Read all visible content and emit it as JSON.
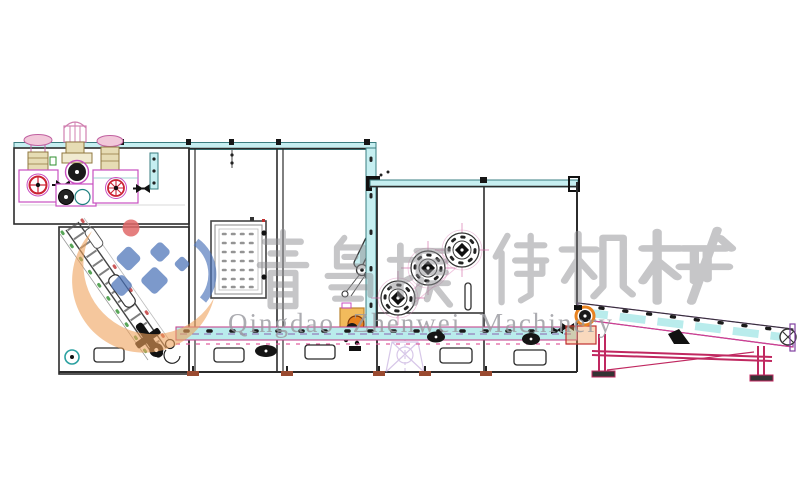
{
  "watermark": {
    "company_cn": "青岛振伟机械",
    "company_cn_chars": [
      "青",
      "岛",
      "振",
      "伟",
      "机",
      "械"
    ],
    "company_en": "Qingdao Zhenwei Machinery",
    "logo_colors": {
      "swoosh": "#efa25c",
      "diamond": "#4a72b8",
      "accent_dot": "#e06868",
      "text_gray": "#9b9ba1"
    }
  },
  "palette": {
    "line_dark": "#2b2b2b",
    "rail_cyan": "#c6eff1",
    "rail_edge": "#3a7d80",
    "machine_magenta": "#c84fc0",
    "motor_red": "#cc2233",
    "belt_cyan": "#b9ecec",
    "belt_magenta": "#c7498f",
    "belt_purple": "#8040a0",
    "frame_crimson": "#c02860",
    "drive_orange": "#e8821e",
    "shaft_khaki": "#e6dcb4",
    "ghost_purple": "#b79ad6",
    "door_dot_gray": "#949494"
  }
}
